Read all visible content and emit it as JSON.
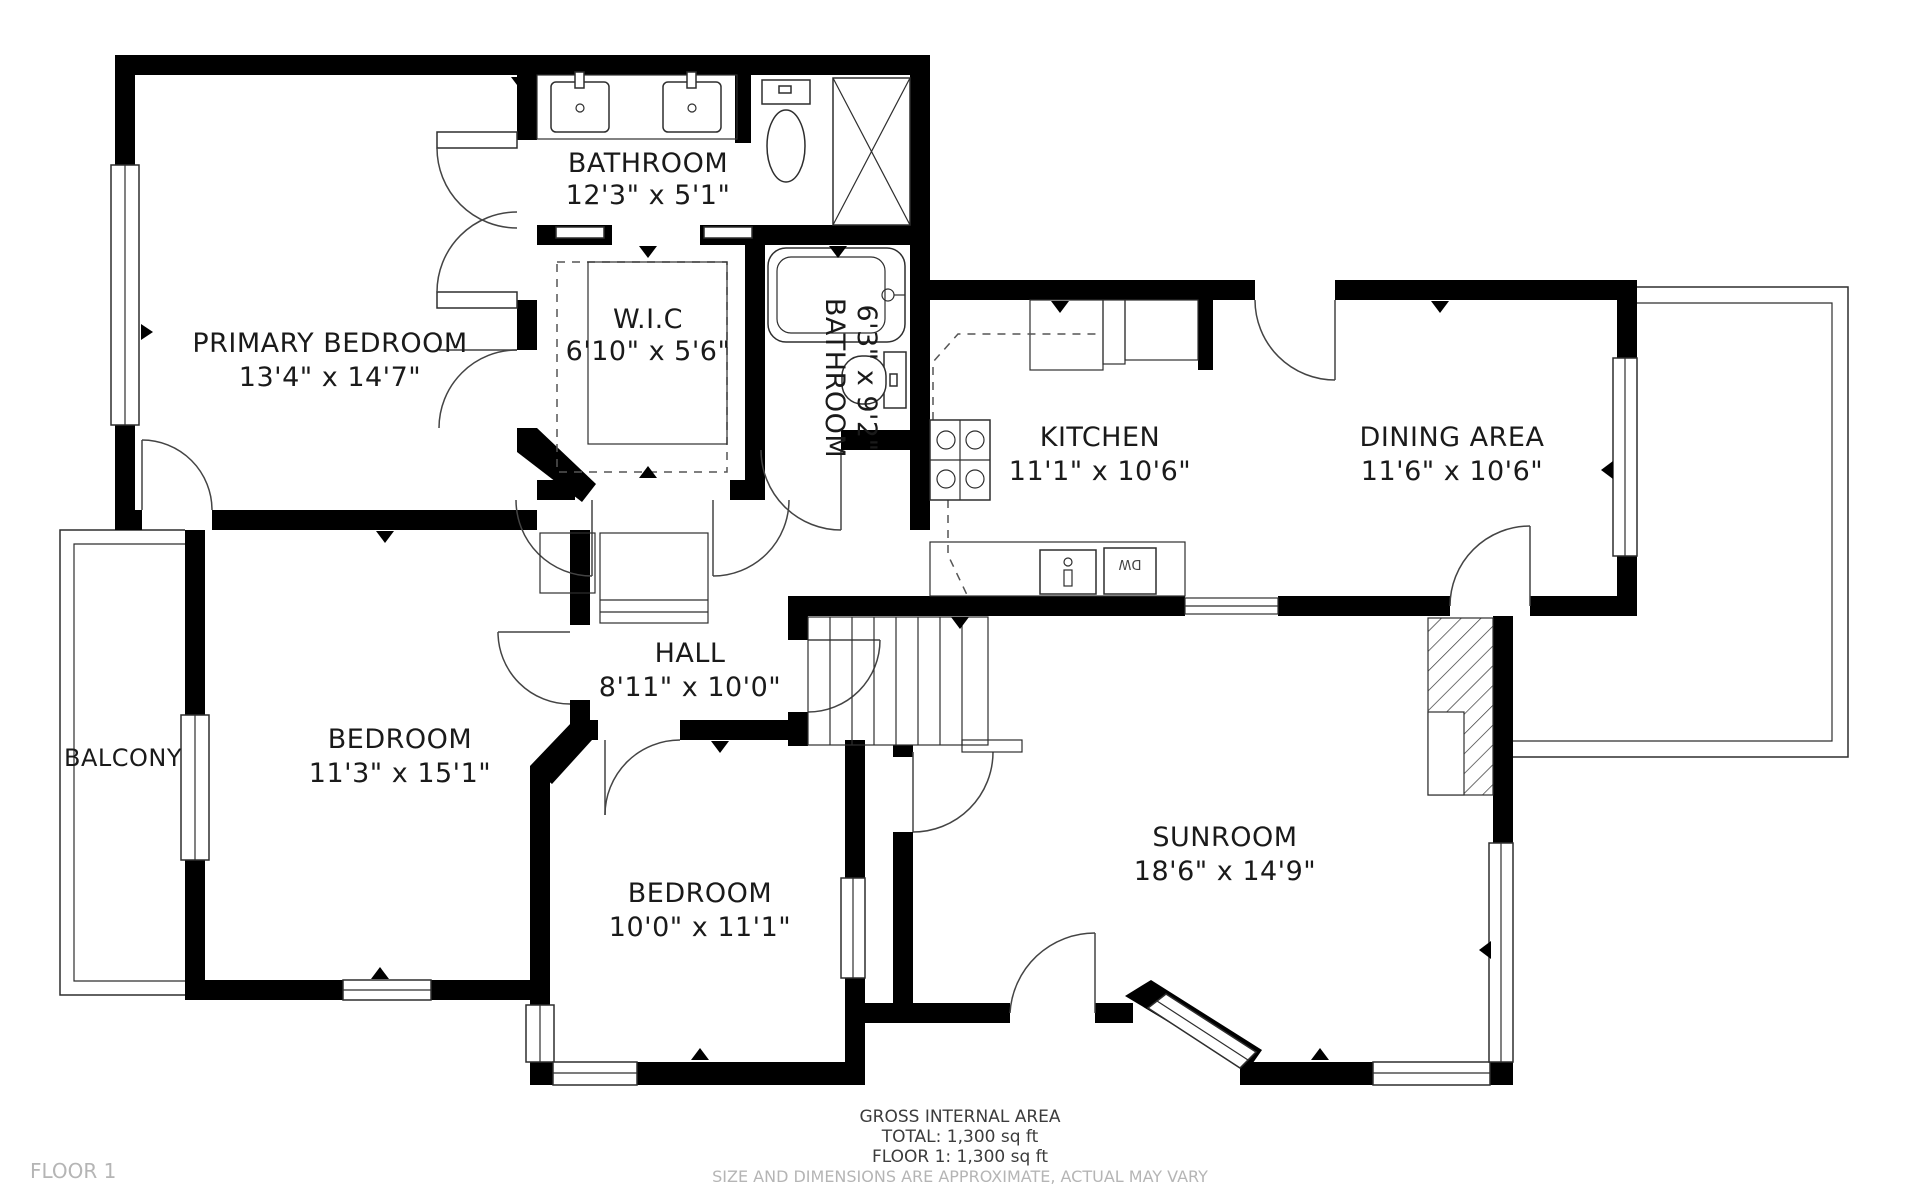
{
  "floorplan": {
    "rooms": {
      "primary_bedroom": {
        "name": "PRIMARY BEDROOM",
        "dims": "13'4\" x 14'7\""
      },
      "bathroom_top": {
        "name": "BATHROOM",
        "dims": "12'3\" x 5'1\""
      },
      "wic": {
        "name": "W.I.C",
        "dims": "6'10\" x 5'6\""
      },
      "bathroom_small": {
        "name": "BATHROOM",
        "dims": "6'3\" x 9'2\""
      },
      "kitchen": {
        "name": "KITCHEN",
        "dims": "11'1\" x 10'6\""
      },
      "dining": {
        "name": "DINING AREA",
        "dims": "11'6\" x 10'6\""
      },
      "hall": {
        "name": "HALL",
        "dims": "8'11\" x 10'0\""
      },
      "bedroom_left": {
        "name": "BEDROOM",
        "dims": "11'3\" x 15'1\""
      },
      "balcony": {
        "name": "BALCONY"
      },
      "bedroom_bottom": {
        "name": "BEDROOM",
        "dims": "10'0\" x 11'1\""
      },
      "sunroom": {
        "name": "SUNROOM",
        "dims": "18'6\" x 14'9\""
      }
    },
    "fixtures": {
      "dishwasher": "DW"
    },
    "footer": {
      "line1": "GROSS INTERNAL AREA",
      "line2": "TOTAL: 1,300 sq ft",
      "line3": "FLOOR 1: 1,300 sq ft",
      "disclaimer": "SIZE AND DIMENSIONS ARE APPROXIMATE, ACTUAL MAY VARY"
    },
    "floor_label": "FLOOR 1",
    "colors": {
      "wall": "#000000",
      "muted": "#b5b5b5"
    }
  }
}
